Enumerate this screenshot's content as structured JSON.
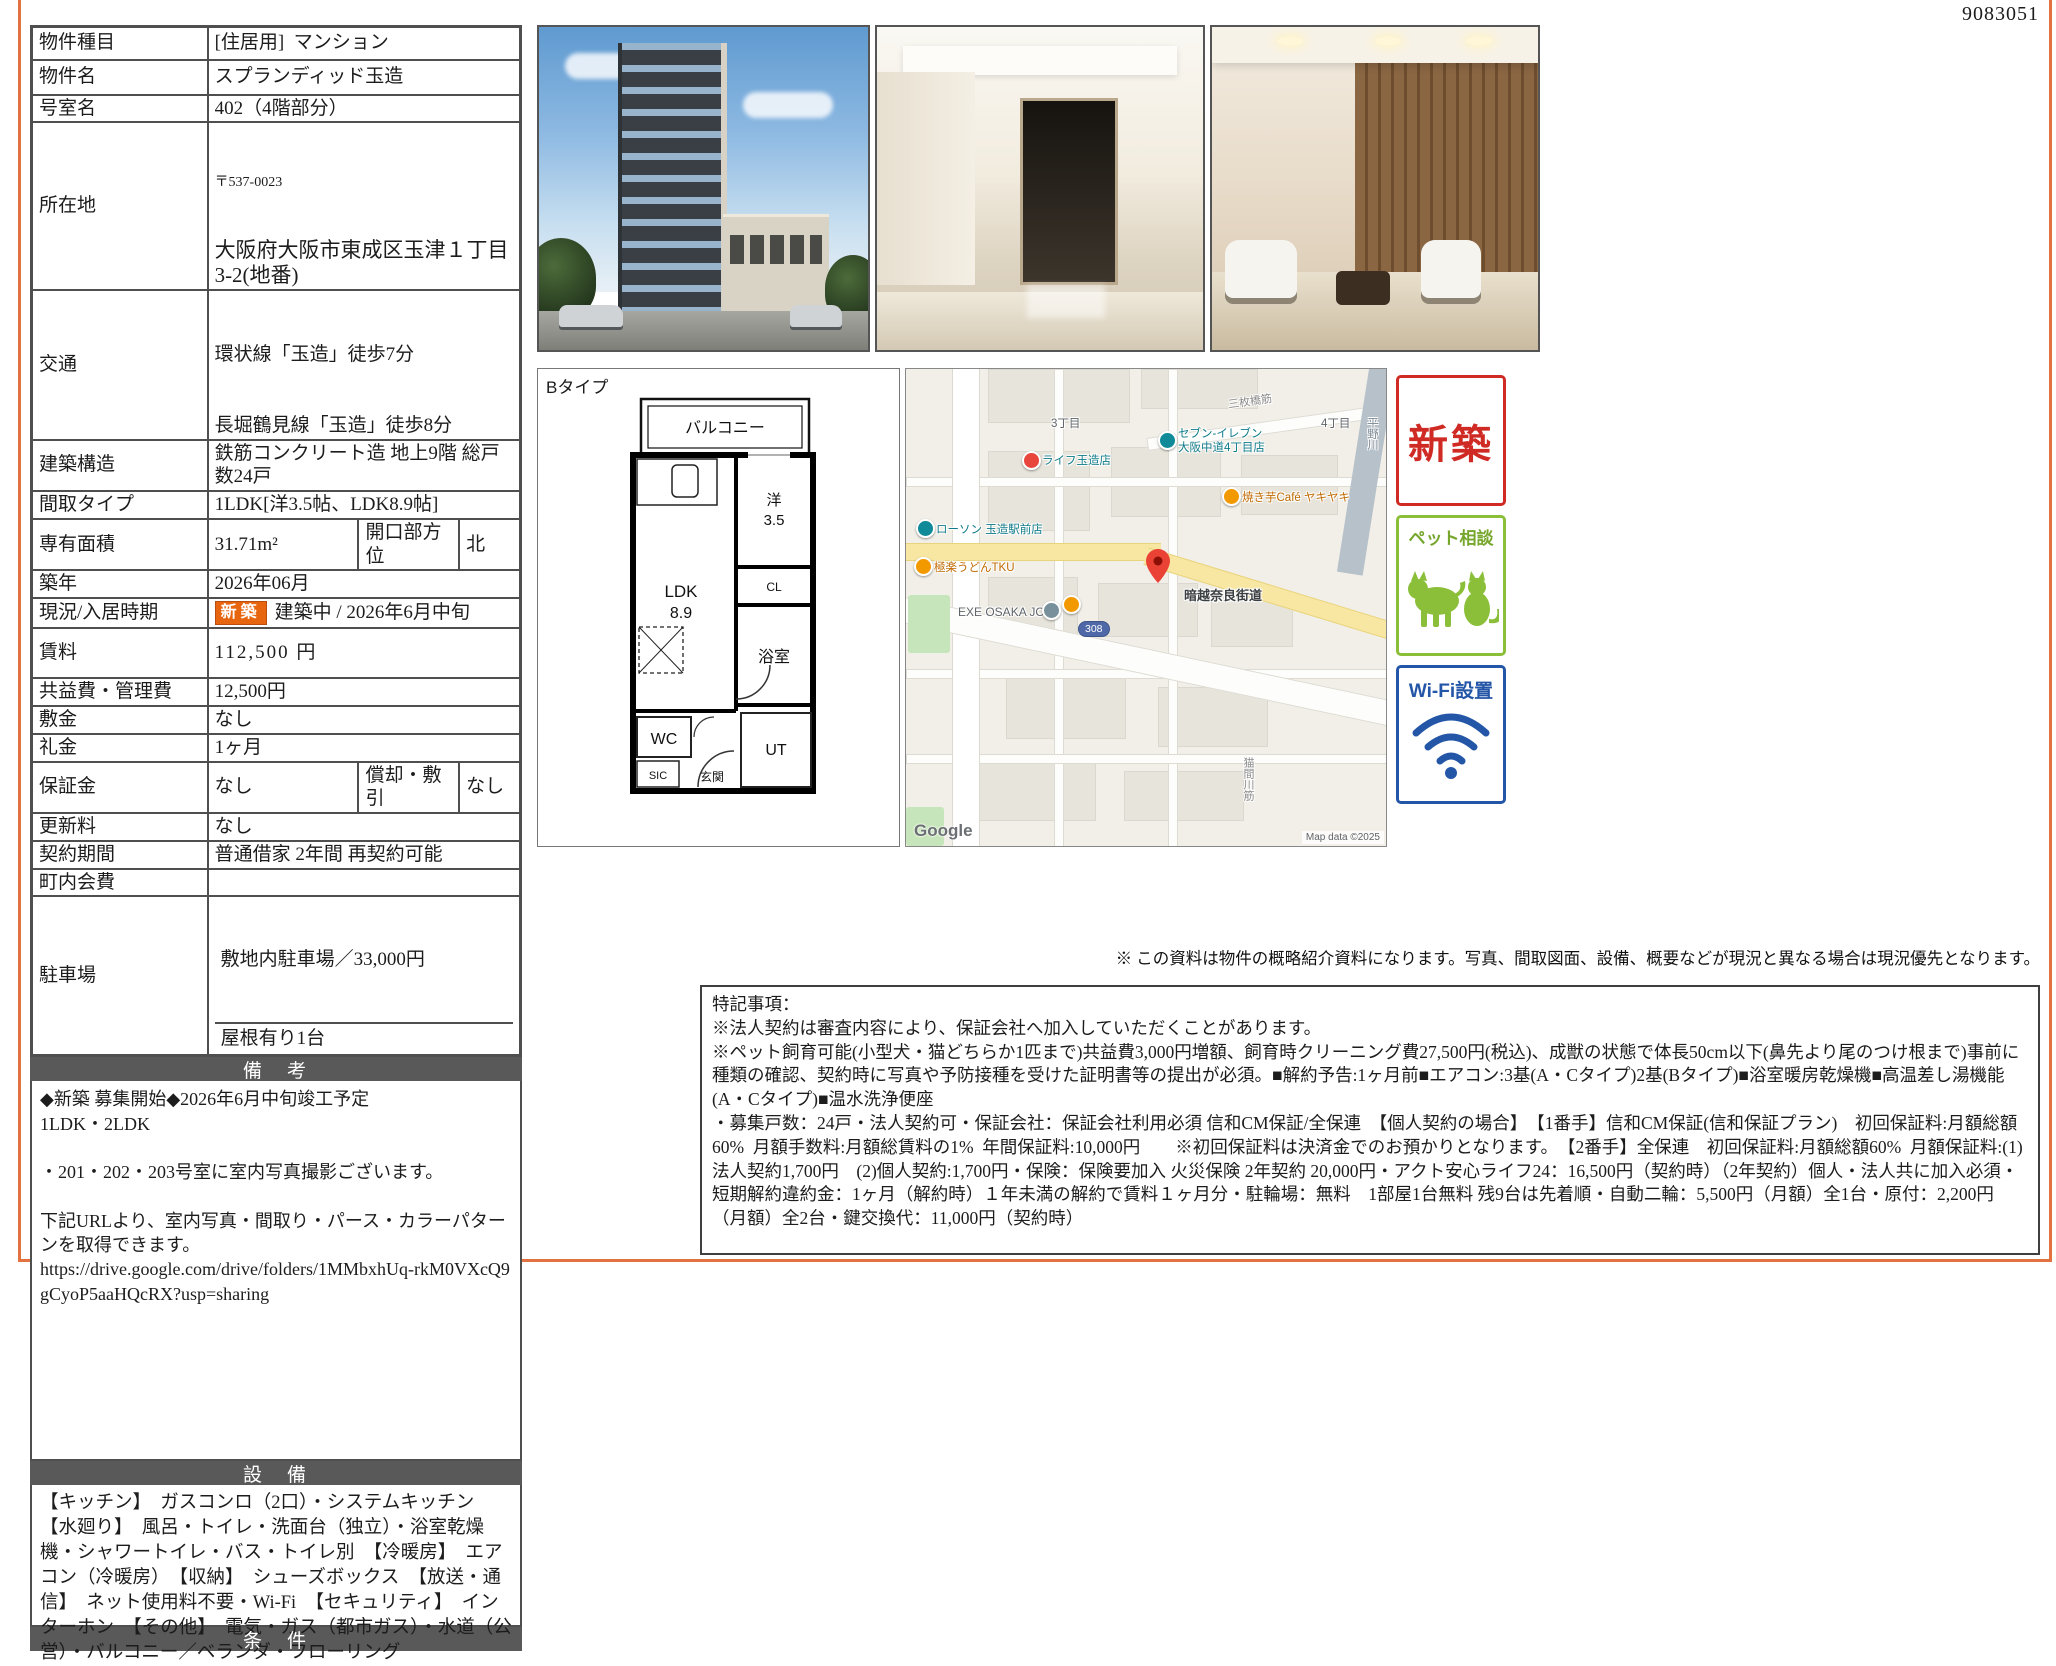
{
  "page": {
    "doc_number": "9083051"
  },
  "colors": {
    "page_border": "#e2723f",
    "section_bar": "#595959",
    "new_stamp_orange": "#e8650f",
    "badge_new_red": "#cf2b24",
    "badge_pet_green": "#8bbf3a",
    "badge_wifi_blue": "#2456a8",
    "map_marker_red": "#ea4335"
  },
  "property_table": {
    "rows": [
      {
        "label": "物件種目",
        "value": "[住居用]  マンション"
      },
      {
        "label": "物件名",
        "value": "スプランディッド玉造"
      },
      {
        "label": "号室名",
        "value": "402（4階部分）"
      },
      {
        "label": "所在地",
        "postal": "〒537-0023",
        "value": "大阪府大阪市東成区玉津１丁目3-2(地番)"
      },
      {
        "label": "交通",
        "line1": "環状線「玉造」徒歩7分",
        "line2": "長堀鶴見線「玉造」徒歩8分"
      },
      {
        "label": "建築構造",
        "value": "鉄筋コンクリート造 地上9階 総戸数24戸"
      },
      {
        "label": "間取タイプ",
        "value": "1LDK[洋3.5帖、LDK8.9帖]"
      },
      {
        "label": "専有面積",
        "value": "31.71m²",
        "label2": "開口部方位",
        "value2": "北"
      },
      {
        "label": "築年",
        "value": "2026年06月"
      },
      {
        "label": "現況/入居時期",
        "badge": "新築",
        "value": "建築中 / 2026年6月中旬"
      },
      {
        "label": "賃料",
        "value": "112,500 円"
      },
      {
        "label": "共益費・管理費",
        "value": "12,500円"
      },
      {
        "label": "敷金",
        "value": "なし"
      },
      {
        "label": "礼金",
        "value": "1ヶ月"
      },
      {
        "label": "保証金",
        "value": "なし",
        "label2": "償却・敷引",
        "value2": "なし"
      },
      {
        "label": "更新料",
        "value": "なし"
      },
      {
        "label": "契約期間",
        "value": "普通借家 2年間 再契約可能"
      },
      {
        "label": "町内会費",
        "value": ""
      },
      {
        "label": "駐車場",
        "value": "敷地内駐車場／33,000円",
        "value2": "屋根有り1台"
      }
    ]
  },
  "remarks": {
    "header": "備　考",
    "text": "◆新築 募集開始◆2026年6月中旬竣工予定\n1LDK・2LDK\n\n・201・202・203号室に室内写真撮影ございます。\n\n下記URLより、室内写真・間取り・パース・カラーパターンを取得できます。\nhttps://drive.google.com/drive/folders/1MMbxhUq-rkM0VXcQ9gCyoP5aaHQcRX?usp=sharing"
  },
  "equipment": {
    "header": "設　備",
    "text": "【キッチン】　ガスコンロ（2口）・システムキッチン　【水廻り】　風呂・トイレ・洗面台（独立）・浴室乾燥機・シャワートイレ・バス・トイレ別　【冷暖房】　エアコン（冷暖房）　【収納】　シューズボックス　【放送・通信】　ネット使用料不要・Wi-Fi　【セキュリティ】　インターホン　【その他】　電気・ガス（都市ガス）・水道（公営）・バルコニー／ベランダ・フローリング"
  },
  "conditions": {
    "header": "条　件"
  },
  "photos": {
    "exterior": "building-exterior-render",
    "entrance": "entrance-hall",
    "lobby": "lobby-interior"
  },
  "floor_plan": {
    "type_label": "Bタイプ",
    "balcony": "バルコニー",
    "ldk": "LDK",
    "ldk_size": "8.9",
    "western": "洋",
    "western_size": "3.5",
    "closet": "CL",
    "bath": "浴室",
    "wc": "WC",
    "ut": "UT",
    "sic": "SIC",
    "entrance": "玄関"
  },
  "map": {
    "road_sanmaibashi": "三枚橋筋",
    "district_3": "3丁目",
    "district_4": "4丁目",
    "poi_seven_line1": "セブン-イレブン",
    "poi_seven_line2": "大阪中道4丁目店",
    "poi_life": "ライフ玉造店",
    "poi_cafe": "焼き芋Café ヤキヤキ",
    "poi_lawson": "ローソン 玉造駅前店",
    "poi_udon": "極楽うどんTKU",
    "poi_exe": "EXE OSAKA JO",
    "road_kaido": "暗越奈良街道",
    "route_shield": "308",
    "road_nekoma": "猫間川筋",
    "river_hirano": "平野川",
    "google_logo": "Google",
    "copyright": "Map data ©2025"
  },
  "badges": {
    "new": "新築",
    "pet": "ペット相談",
    "wifi": "Wi-Fi設置"
  },
  "disclaimer": "※ この資料は物件の概略紹介資料になります。写真、間取図面、設備、概要などが現況と異なる場合は現況優先となります。",
  "notes": {
    "text": "特記事項：\n※法人契約は審査内容により、保証会社へ加入していただくことがあります。\n※ペット飼育可能(小型犬・猫どちらか1匹まで)共益費3,000円増額、飼育時クリーニング費27,500円(税込)、成獣の状態で体長50cm以下(鼻先より尾のつけ根まで)事前に種類の確認、契約時に写真や予防接種を受けた証明書等の提出が必須。■解約予告:1ヶ月前■エアコン:3基(A・Cタイプ)2基(Bタイプ)■浴室暖房乾燥機■高温差し湯機能(A・Cタイプ)■温水洗浄便座\n・募集戸数：24戸・法人契約可・保証会社：保証会社利用必須 信和CM保証/全保連　【個人契約の場合】　【1番手】信和CM保証(信和保証プラン)　初回保証料:月額総額60%  月額手数料:月額総賃料の1%  年間保証料:10,000円　　※初回保証料は決済金でのお預かりとなります。　【2番手】全保連　初回保証料:月額総額60%  月額保証料:(1)法人契約1,700円　(2)個人契約:1,700円・保険：保険要加入 火災保険 2年契約 20,000円・アクト安心ライフ24：16,500円（契約時）（2年契約）個人・法人共に加入必須・短期解約違約金：1ヶ月（解約時）１年未満の解約で賃料１ヶ月分・駐輪場：無料　1部屋1台無料 残9台は先着順・自動二輪：5,500円（月額）全1台・原付：2,200円（月額）全2台・鍵交換代：11,000円（契約時）"
  }
}
